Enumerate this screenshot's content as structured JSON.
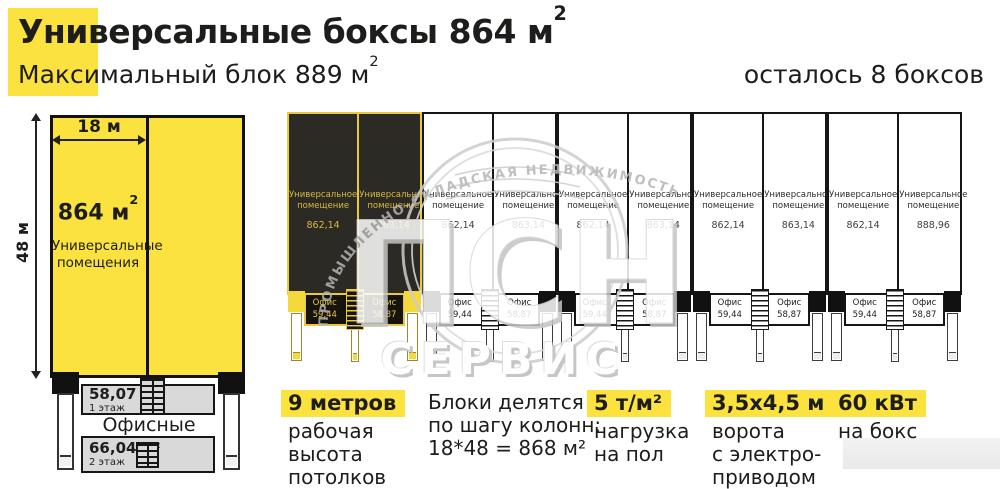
{
  "header": {
    "title": "Универсальные боксы 864 м",
    "title_sup": "2",
    "subtitle": "Максимальный блок 889 м",
    "subtitle_sup": "2",
    "remaining": "осталось 8 боксов"
  },
  "left_plan": {
    "width_label": "18 м",
    "height_label": "48 м",
    "area": "864 м",
    "area_sup": "2",
    "area_caption": "Универсальные помещения",
    "floor1_area": "58,07 м²",
    "floor1_label": "1 этаж",
    "offices_label": "Офисные помещения",
    "floor2_area": "66,04 м²",
    "floor2_label": "2 этаж"
  },
  "boxes": {
    "unit_line1": "Универсальное",
    "unit_line2": "помещение",
    "office_label": "Офис",
    "pairs": [
      {
        "sold": true,
        "left_area": "862,14",
        "right_area": "863,14",
        "office_left": "59,44",
        "office_right": "58,87"
      },
      {
        "sold": false,
        "left_area": "862,14",
        "right_area": "863,14",
        "office_left": "59,44",
        "office_right": "58,87"
      },
      {
        "sold": false,
        "left_area": "862,14",
        "right_area": "863,14",
        "office_left": "59,44",
        "office_right": "58,87"
      },
      {
        "sold": false,
        "left_area": "862,14",
        "right_area": "863,14",
        "office_left": "59,44",
        "office_right": "58,87"
      },
      {
        "sold": false,
        "left_area": "862,14",
        "right_area": "888,96",
        "office_left": "59,44",
        "office_right": "58,87"
      }
    ]
  },
  "watermark": {
    "arc_text": "ПРОМЫШЛЕННО-СКЛАДСКАЯ НЕДВИЖИМОСТЬ",
    "logo": "ПСН",
    "logo_sub": "СЕРВИС"
  },
  "features": [
    {
      "highlight": "9 метров",
      "lines": [
        "рабочая",
        "высота",
        "потолков"
      ]
    },
    {
      "highlight": "",
      "lines": [
        "Блоки делятся",
        "по шагу колонн:",
        "18*48 = 868 м²"
      ]
    },
    {
      "highlight": "5 т/м²",
      "lines": [
        "нагрузка",
        "на пол"
      ]
    },
    {
      "highlight": "3,5х4,5 м",
      "lines": [
        "ворота",
        "с электро-",
        "приводом"
      ]
    },
    {
      "highlight": "60 кВт",
      "lines": [
        "на бокс"
      ]
    }
  ],
  "colors": {
    "accent_yellow": "#FBE23E",
    "sold_box_fill": "#2B2A25",
    "sold_box_text": "#D9BA3C",
    "ink": "#1D1D1B",
    "office_gray": "#D9D9D9"
  }
}
